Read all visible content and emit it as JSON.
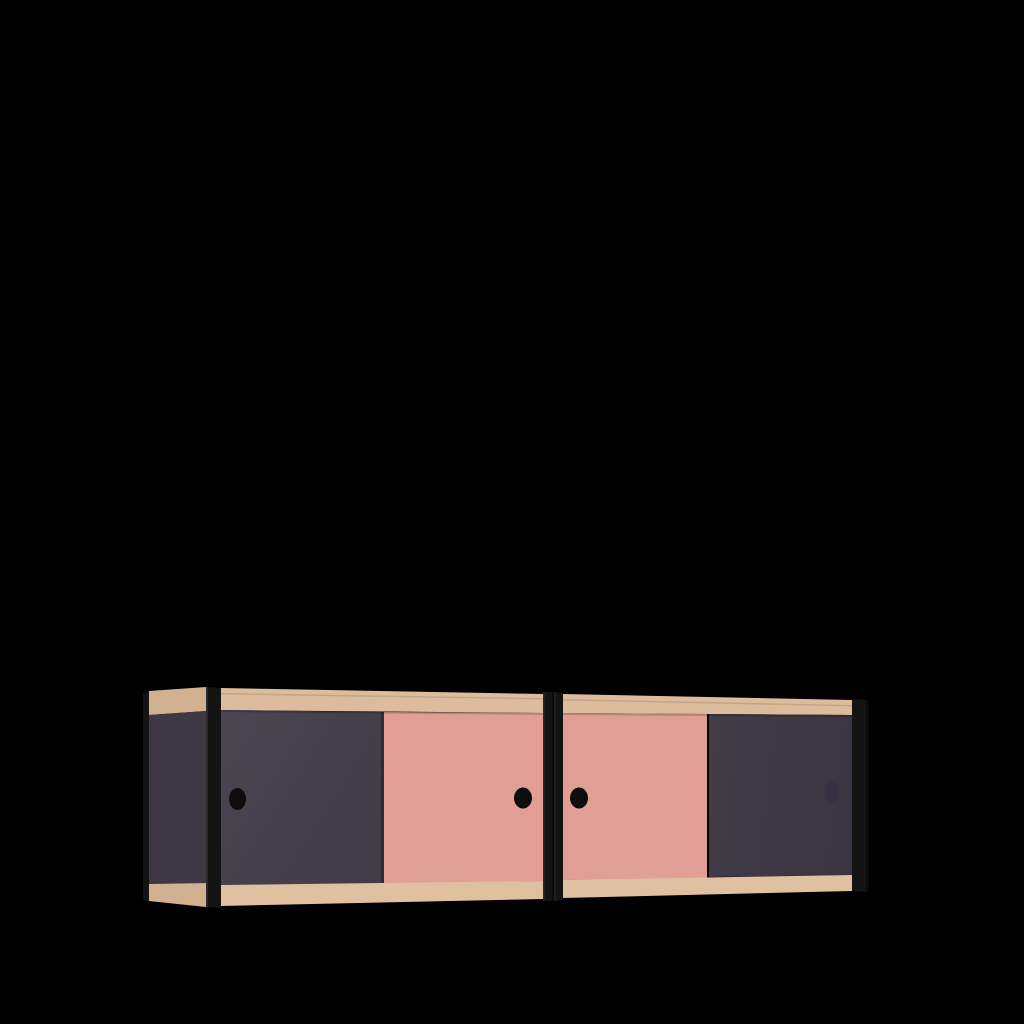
{
  "scene": {
    "description": "3D product render of a wall-mounted two-module sideboard with sliding doors on a solid black background",
    "background_color": "#000000"
  },
  "product": {
    "kind": "sideboard / wall cabinet render",
    "modules": 2,
    "doors_per_module": 2,
    "door_color_order": [
      "dark-purple",
      "pink",
      "pink",
      "dark-purple"
    ],
    "frame_material": "plywood / wood rails",
    "vertical_rails": "black",
    "handles": "round finger holes, one per door"
  },
  "colors": {
    "background": "#000000",
    "wood_front": "#dcbc9c",
    "wood_front_light": "#dfc0a1",
    "wood_side": "#d2b190",
    "purple_door": "#423c48",
    "purple_door_light": "#4b4552",
    "purple_door_dark": "#3a3541",
    "purple_side": "#3e3844",
    "pink_door": "#e29e94",
    "black_rail": "#141414",
    "black_rail_highlight": "#303030",
    "black_rail_dark": "#0a0a0a",
    "finger_hole": "#0d0d0d",
    "finger_hole_subtle": "#353042",
    "shadow": "#000000"
  }
}
